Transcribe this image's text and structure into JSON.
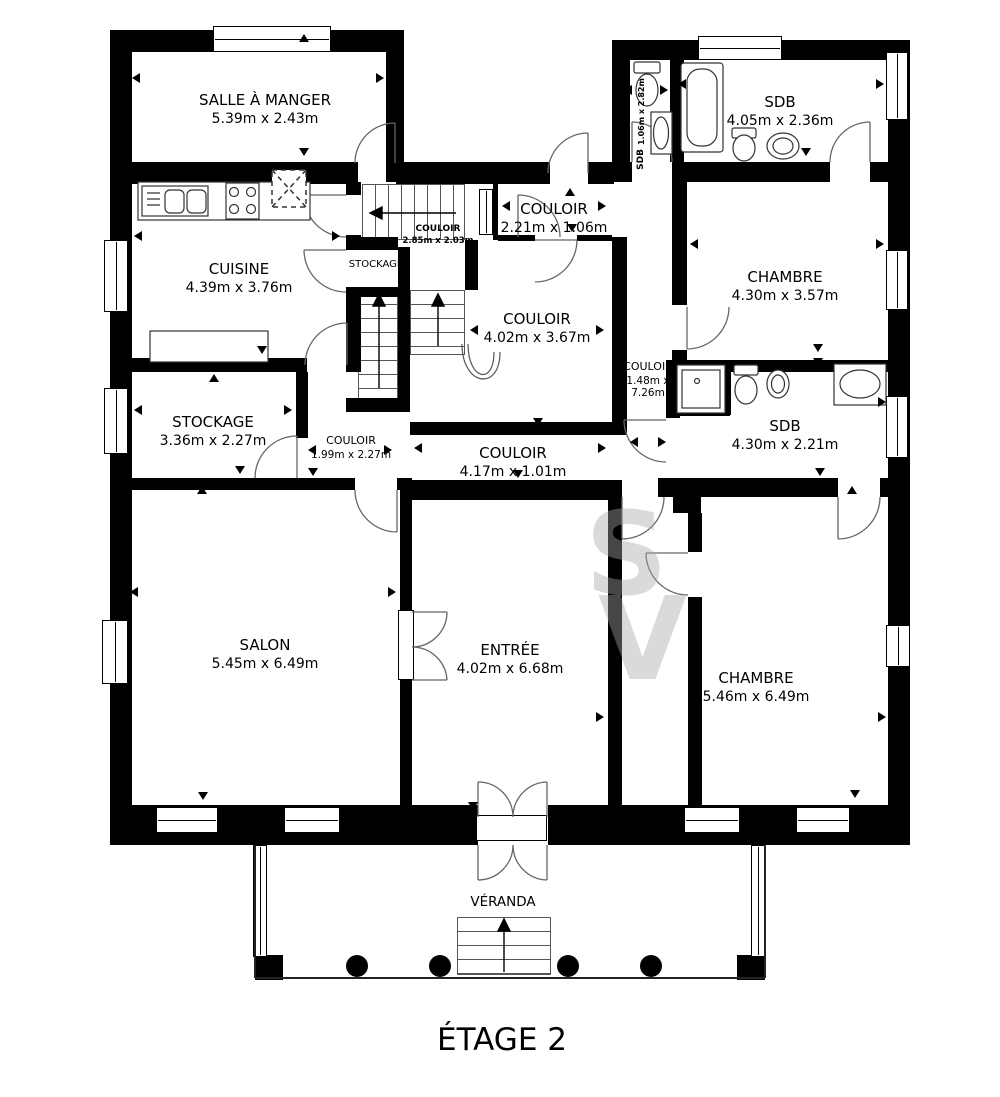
{
  "floor_label": "ÉTAGE 2",
  "watermark": "SV",
  "rooms": {
    "salle_a_manger": {
      "name": "SALLE À MANGER",
      "dims": "5.39m x 2.43m"
    },
    "sdb_top": {
      "name": "SDB",
      "dims": "4.05m x 2.36m"
    },
    "wc_top": {
      "name": "SDB",
      "dims": "1.06m x 2.82m"
    },
    "couloir_top": {
      "name": "COULOIR",
      "dims": "2.21m x 1.06m"
    },
    "cuisine": {
      "name": "CUISINE",
      "dims": "4.39m x 3.76m"
    },
    "couloir_small": {
      "name": "COULOIR",
      "dims": "2.85m x 2.03m"
    },
    "stockage_small": {
      "name": "STOCKAGE",
      "dims": ""
    },
    "couloir_mid": {
      "name": "COULOIR",
      "dims": "4.02m x 3.67m"
    },
    "chambre_top": {
      "name": "CHAMBRE",
      "dims": "4.30m x 3.57m"
    },
    "stockage": {
      "name": "STOCKAGE",
      "dims": "3.36m x 2.27m"
    },
    "couloir_199": {
      "name": "COULOIR",
      "dims": "1.99m x 2.27m"
    },
    "couloir_vert": {
      "name": "COULOIR",
      "dims": "1.48m x 7.26m"
    },
    "sdb_mid": {
      "name": "SDB",
      "dims": "4.30m x 2.21m"
    },
    "couloir_417": {
      "name": "COULOIR",
      "dims": "4.17m x 1.01m"
    },
    "salon": {
      "name": "SALON",
      "dims": "5.45m x 6.49m"
    },
    "entree": {
      "name": "ENTRÉE",
      "dims": "4.02m x 6.68m"
    },
    "chambre_bottom": {
      "name": "CHAMBRE",
      "dims": "5.46m x 6.49m"
    },
    "veranda": {
      "name": "VÉRANDA",
      "dims": ""
    }
  }
}
